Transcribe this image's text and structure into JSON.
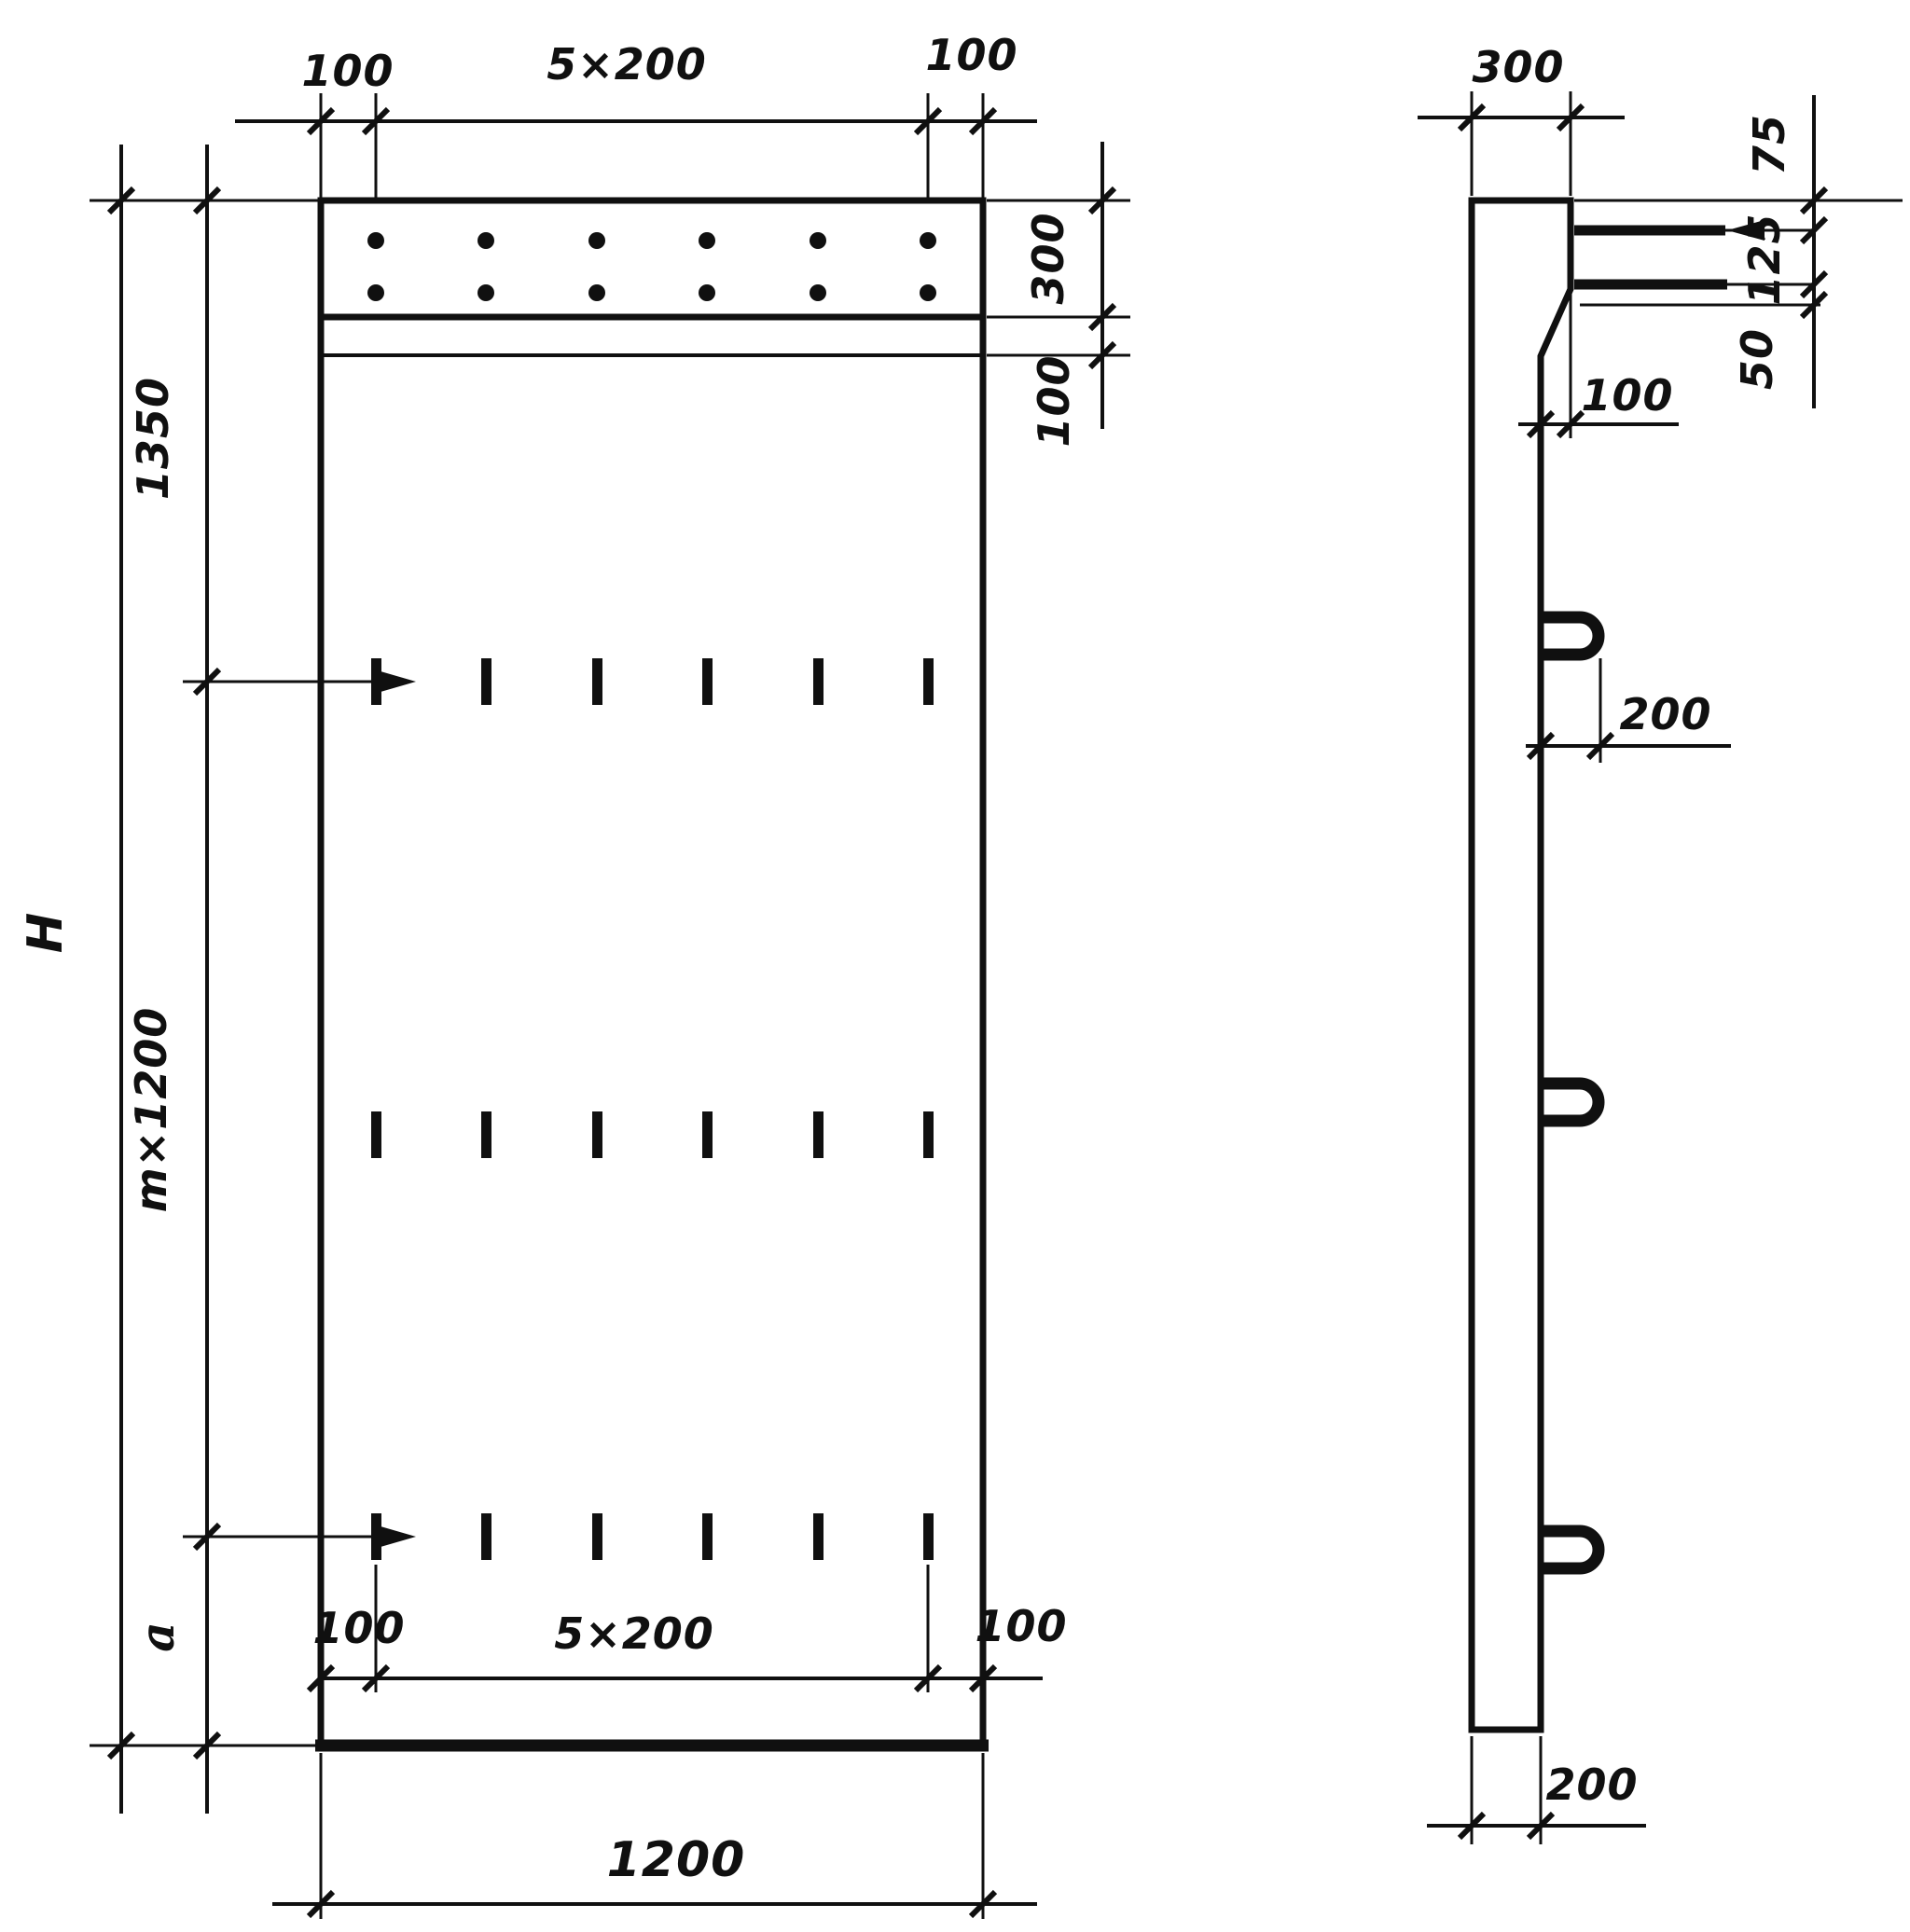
{
  "drawing": {
    "front": {
      "top": {
        "left_margin": "100",
        "spacing": "5×200",
        "right_margin": "100"
      },
      "right": {
        "band_height": "300",
        "strip_height": "100"
      },
      "left": {
        "upper": "1350",
        "total_height": "H",
        "middle": "m×1200",
        "lower": "a"
      },
      "bottom": {
        "left_margin": "100",
        "spacing": "5×200",
        "right_margin": "100",
        "overall_width": "1200"
      }
    },
    "side": {
      "top_width": "300",
      "bar_chain": {
        "top_offset": "75",
        "bar_gap": "125",
        "bottom_clear": "50"
      },
      "step": "100",
      "loop_length": "200",
      "bottom_width": "200"
    }
  }
}
